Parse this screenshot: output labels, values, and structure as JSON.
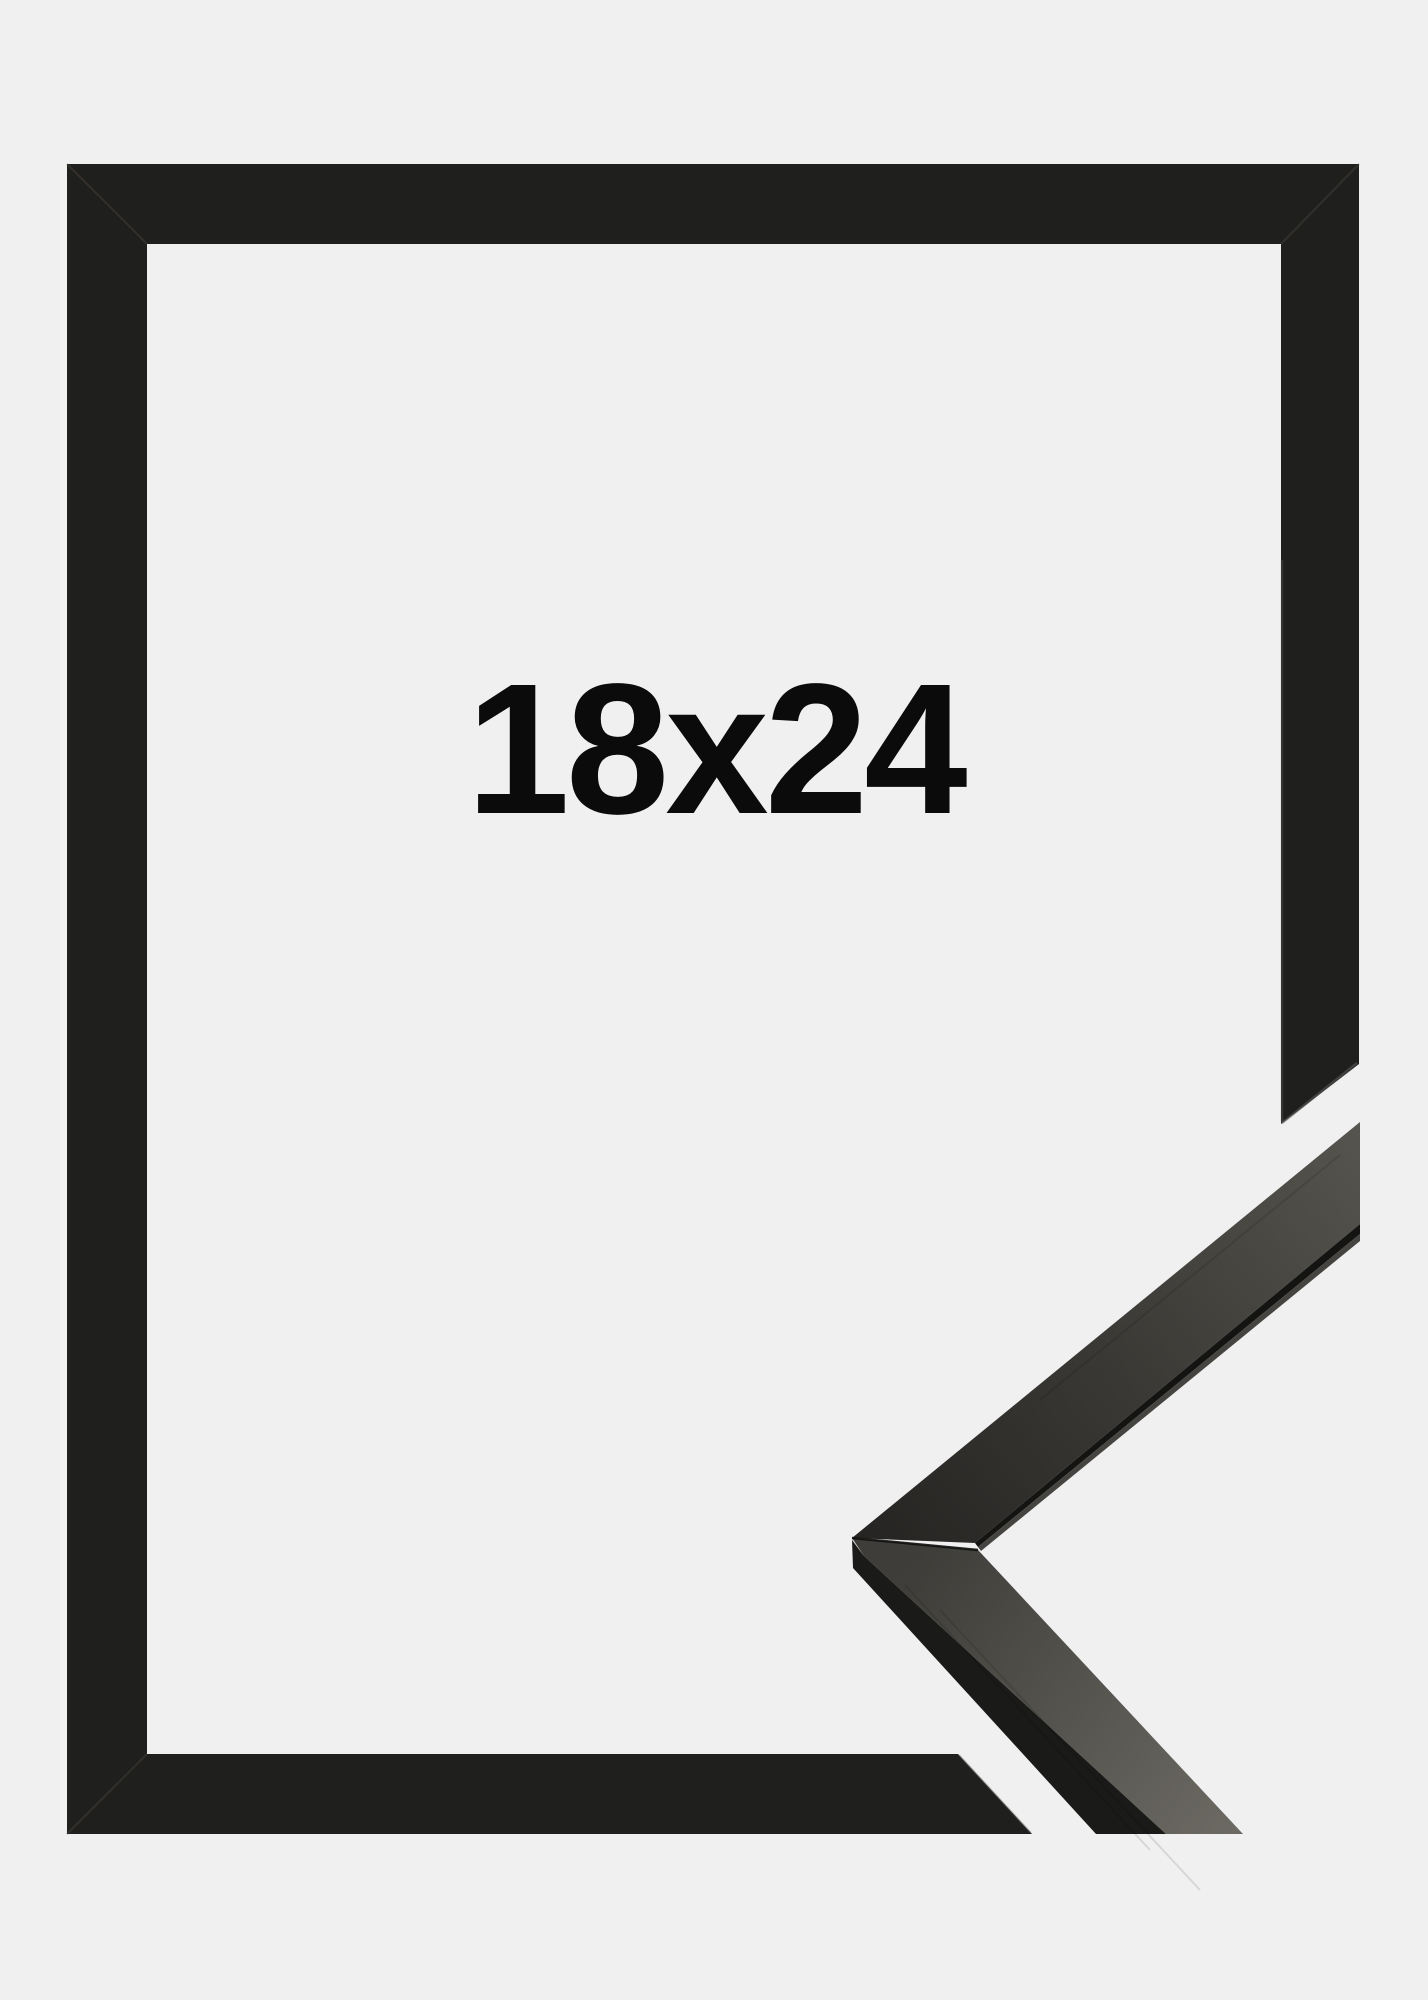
{
  "product_image": {
    "size_label": "18x24",
    "description": "Black wooden picture frame shown empty with a diagonal cut-away detail of the moulding corner profile in the lower right",
    "colors": {
      "background": "#f0f0f1",
      "frame": "#1f1f1e",
      "frame_seam": "#4a443c",
      "cut_edge_highlight": "#5d5d5a",
      "inner_edge_highlight": "#6a6a66",
      "label_text": "#0b0b0b",
      "moulding_upper_face_dark": "#262523",
      "moulding_upper_face_mid": "#3a3834",
      "moulding_upper_face_light": "#56544e",
      "moulding_edge_stripe": "#141413",
      "moulding_edge_sliver": "#454440",
      "moulding_top_face_dark": "#3e3d39",
      "moulding_top_face_light": "#6b6962",
      "moulding_front_face": "#1a1a19",
      "miter_joint_shadow": "#0e0e0d"
    }
  }
}
